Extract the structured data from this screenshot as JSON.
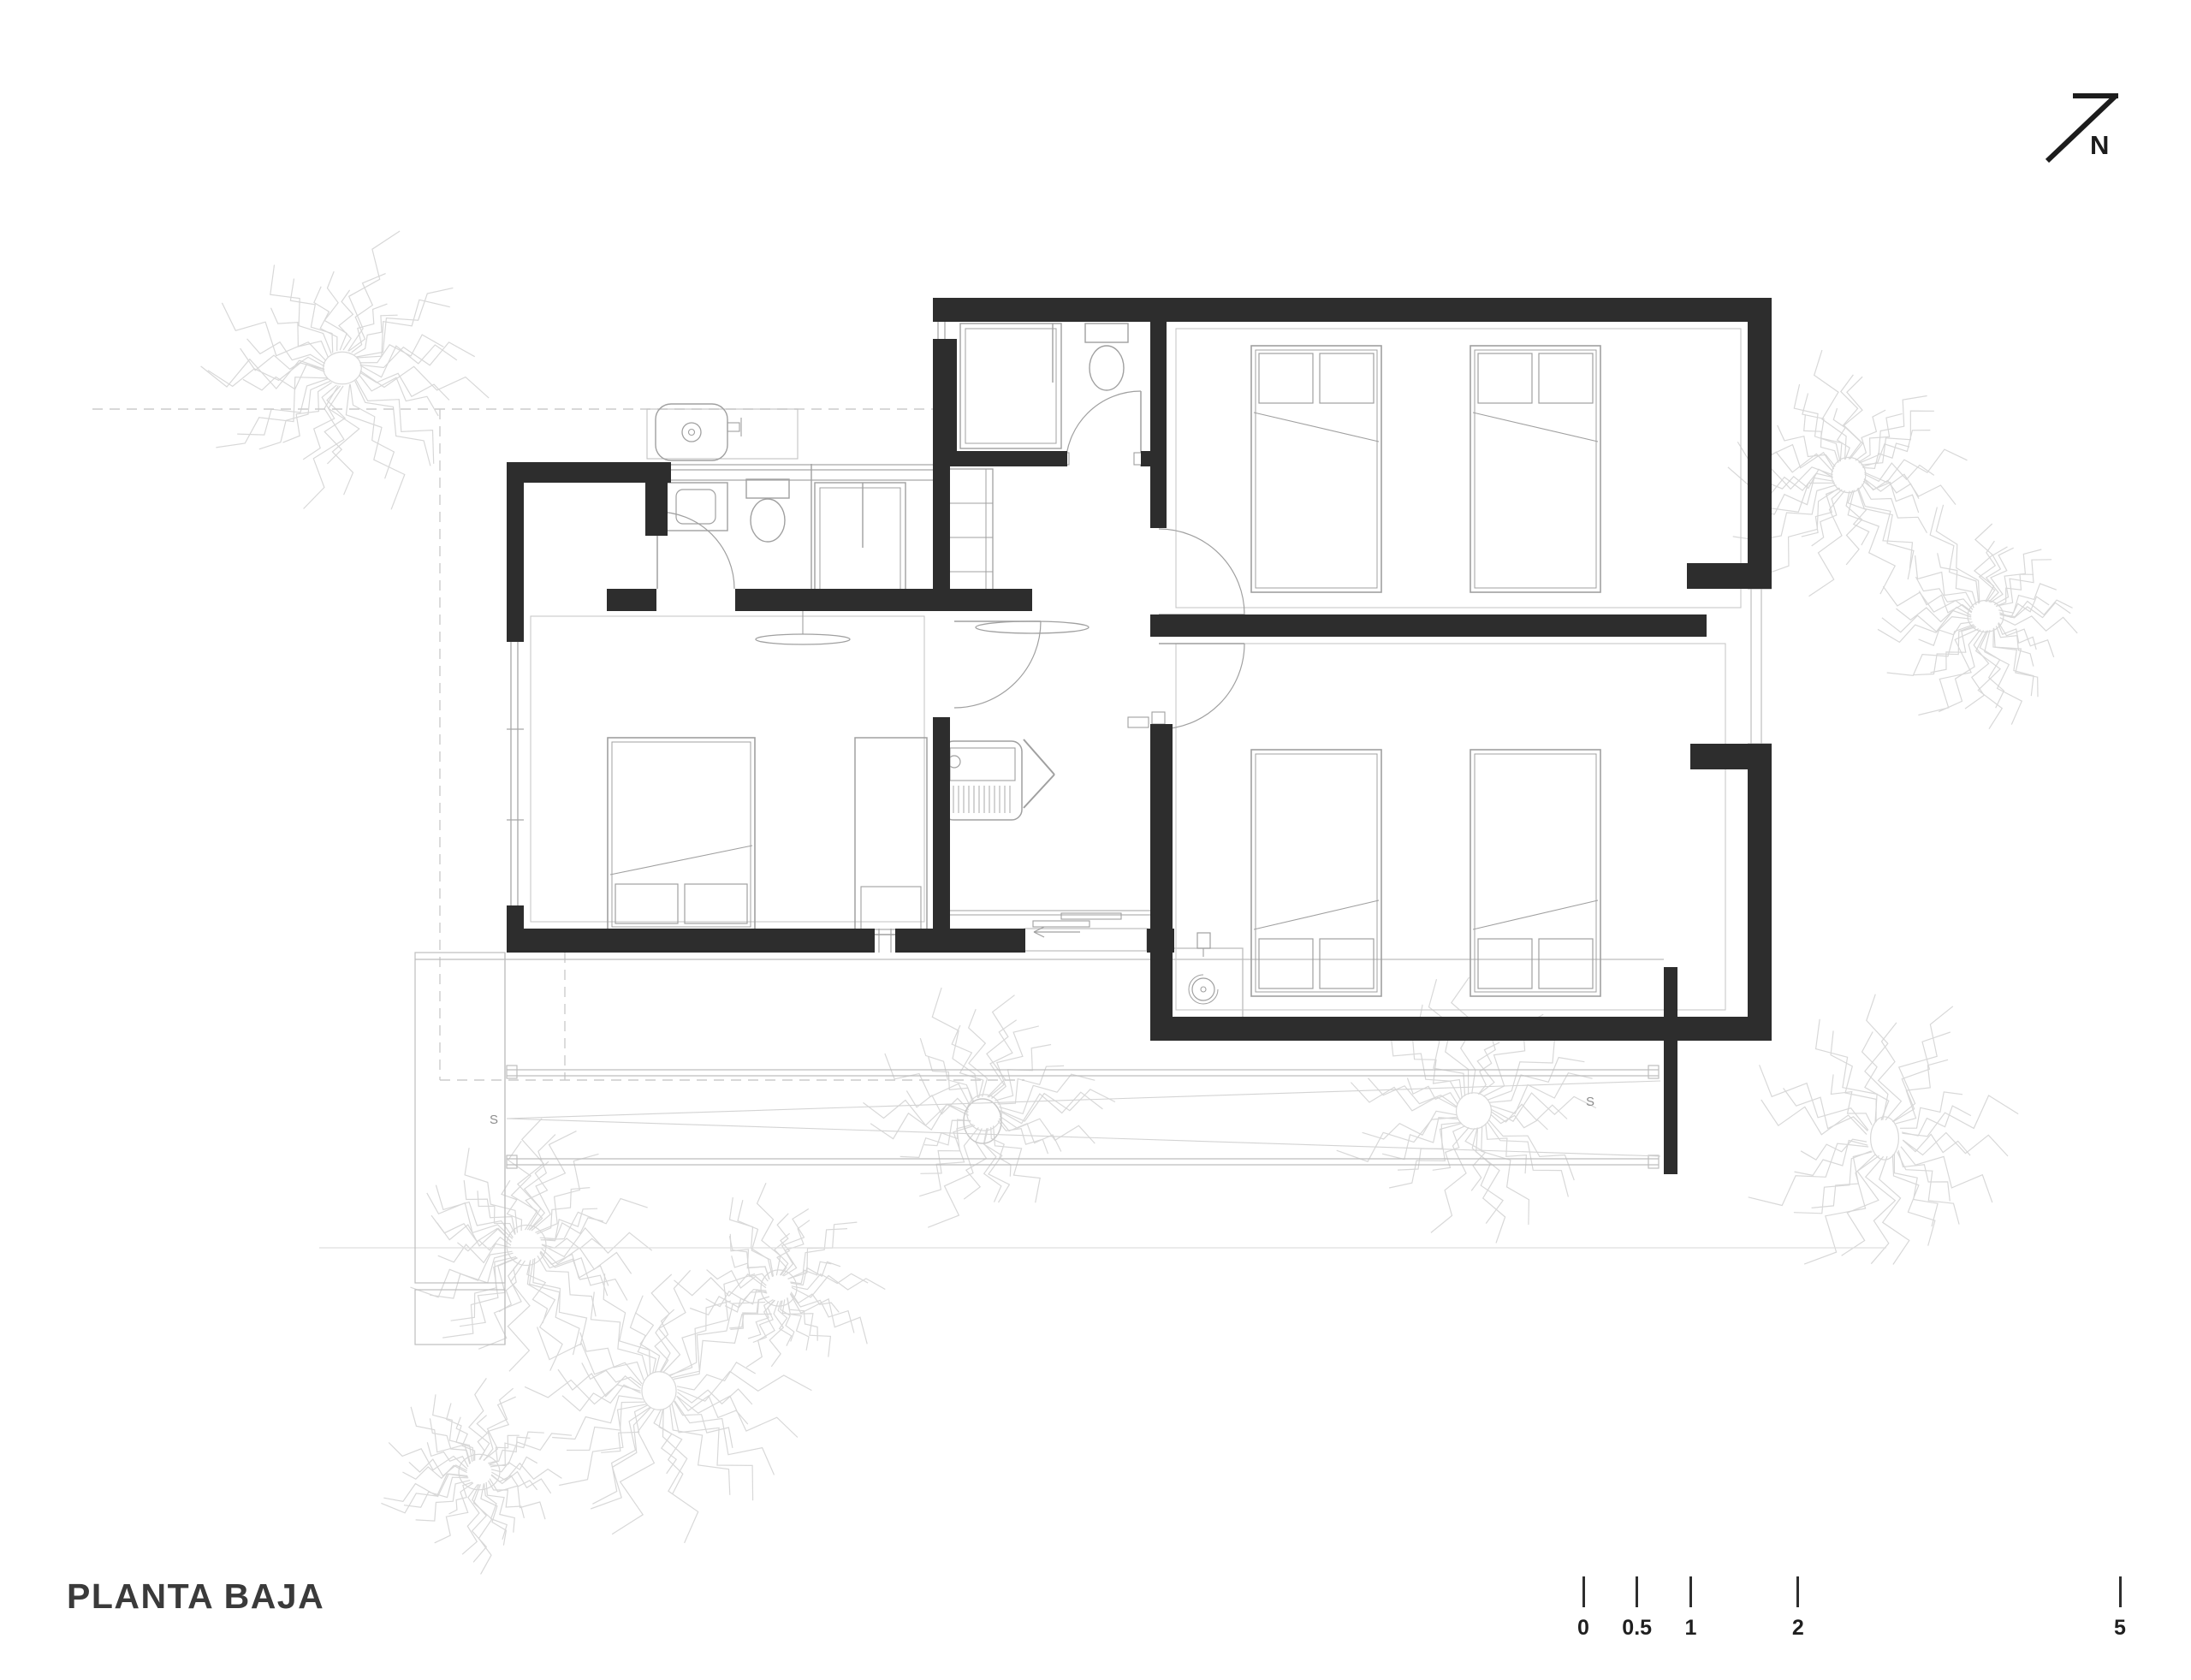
{
  "title": "PLANTA BAJA",
  "north_label": "N",
  "annotations": {
    "slope_left": "S",
    "slope_right": "S"
  },
  "scale_bar": {
    "ticks": [
      {
        "label": "0"
      },
      {
        "label": "0.5"
      },
      {
        "label": "1"
      },
      {
        "label": "2"
      },
      {
        "label": "5"
      }
    ]
  },
  "icons": {
    "north-arrow": "diagonal-arrow-with-N",
    "drain": "circle-with-arc",
    "door-swing": "quarter-arc",
    "ceiling-fan": "flat-lens",
    "tree": "spiky-palm"
  },
  "colors": {
    "wall": "#2d2d2d",
    "fixture": "#a0a0a0",
    "glazing": "#a8a8a8",
    "faint": "#bdbdbd",
    "inset": "#c8c8c8",
    "dashed": "#cccccc",
    "ground": "#dfdfdf",
    "tree": "#d8d8d8",
    "text": "#3a3a3a",
    "north": "#1c1c1c"
  }
}
